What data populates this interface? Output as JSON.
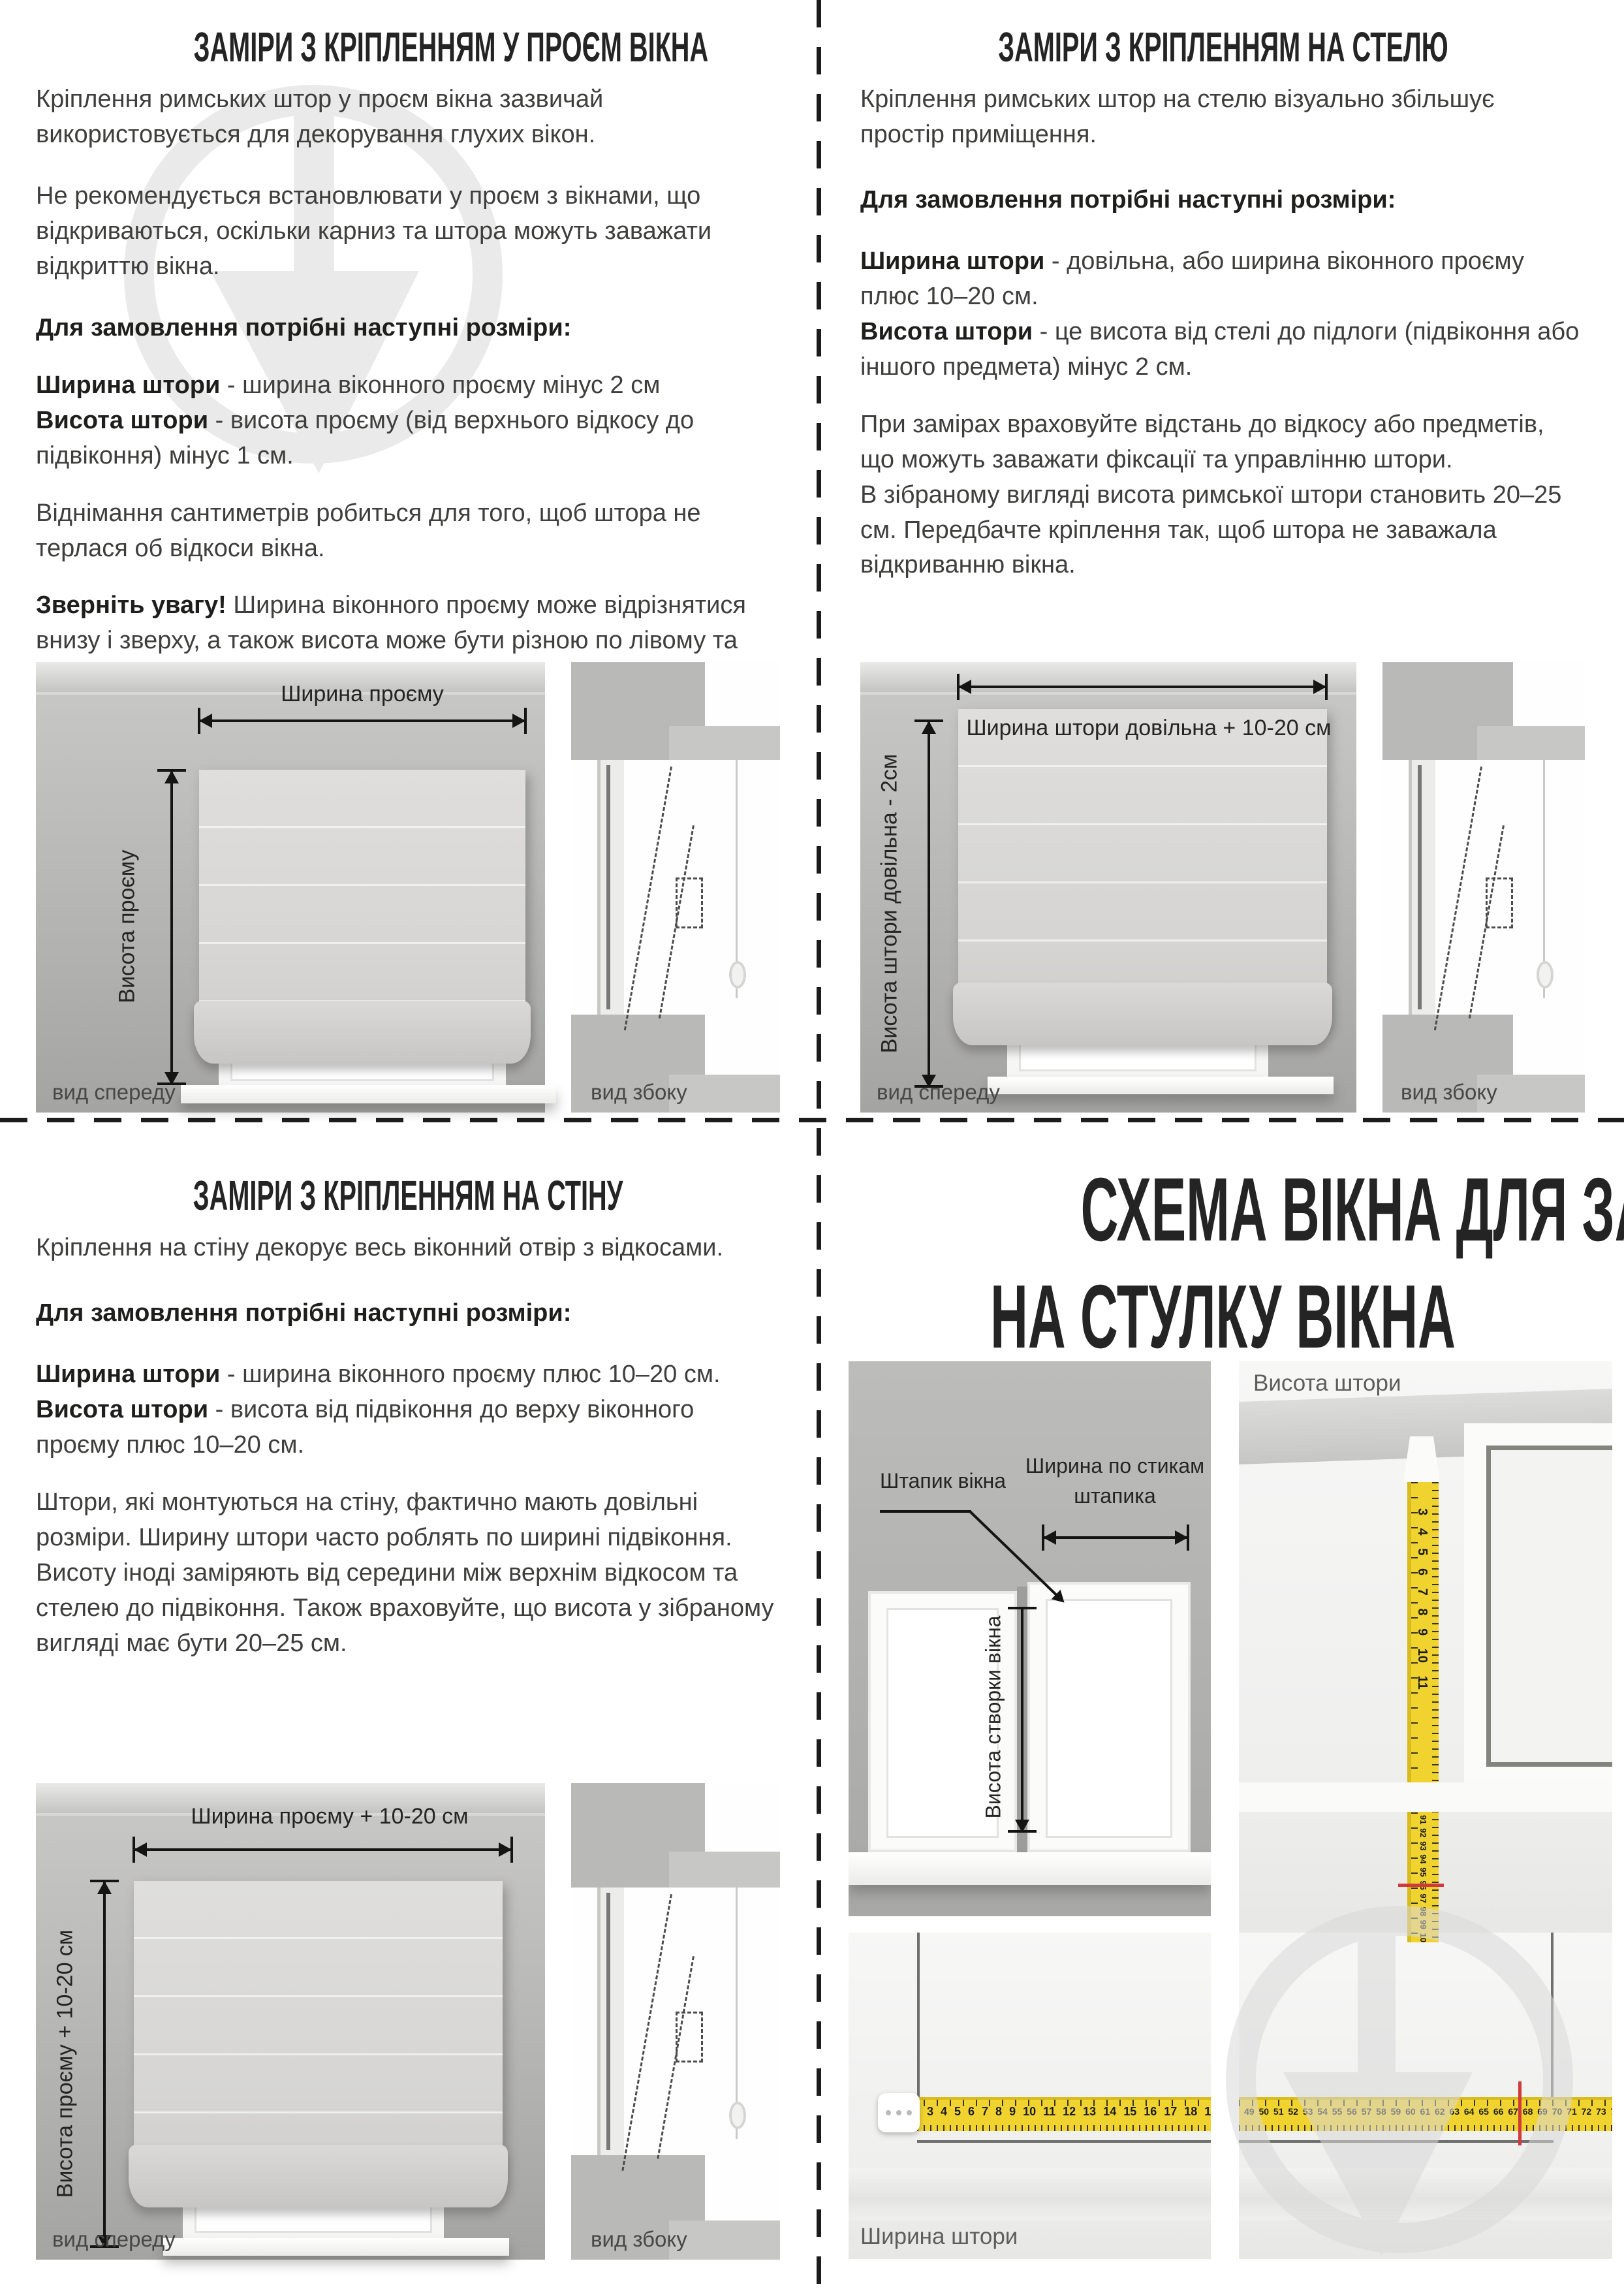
{
  "colors": {
    "tape_yellow": "#f1d32f",
    "red_mark": "#d23a3a",
    "watermark_gray": "#d9d9d9",
    "body_text": "#3e3e3c"
  },
  "opening": {
    "title": "ЗАМІРИ З КРІПЛЕННЯМ У ПРОЄМ ВІКНА",
    "p1": "Кріплення римських штор у проєм вікна зазвичай використовується для декорування глухих вікон.",
    "p2": "Не рекомендується встановлювати у проєм з вікнами, що відкриваються, оскільки карниз та штора можуть заважати відкриттю вікна.",
    "order_intro": "Для замовлення потрібні наступні розміри:",
    "width_term": "Ширина штори",
    "width_rest": " - ширина віконного проєму мінус 2 см",
    "height_term": "Висота штори",
    "height_rest": " - висота проєму (від верхнього відкосу до підвіконня) мінус 1 см.",
    "p3": "Віднімання сантиметрів робиться для того, щоб штора не терлася об відкоси вікна.",
    "note_term": "Зверніть увагу!",
    "note_rest": " Ширина віконного проєму може відрізнятися внизу і зверху, а також висота може бути різною по лівому та правому краях проєму.",
    "diagram": {
      "width_label": "Ширина проєму",
      "height_label": "Висота проєму",
      "front_caption": "вид спереду",
      "side_caption": "вид збоку"
    }
  },
  "ceiling": {
    "title": "ЗАМІРИ З КРІПЛЕННЯМ НА СТЕЛЮ",
    "p1": "Кріплення римських штор на стелю візуально збільшує простір приміщення.",
    "order_intro": "Для замовлення потрібні наступні розміри:",
    "width_term": "Ширина штори",
    "width_rest": " - довільна, або ширина віконного проєму плюс 10–20 см.",
    "height_term": "Висота штори",
    "height_rest": " - це висота від стелі до підлоги (підвіконня або іншого предмета) мінус 2 см.",
    "p2": "При замірах враховуйте відстань до відкосу або предметів, що можуть заважати фіксації та управлінню штори.",
    "p3": "В зібраному вигляді висота римської штори становить 20–25 см. Передбачте кріплення так, щоб штора не заважала відкриванню вікна.",
    "diagram": {
      "width_label": "Ширина штори довільна + 10-20 см",
      "height_label": "Висота штори довільна - 2см",
      "front_caption": "вид спереду",
      "side_caption": "вид збоку"
    }
  },
  "wall": {
    "title": "ЗАМІРИ З КРІПЛЕННЯМ НА СТІНУ",
    "p1": "Кріплення на стіну декорує весь віконний отвір з відкосами.",
    "order_intro": "Для замовлення потрібні наступні розміри:",
    "width_term": "Ширина штори",
    "width_rest": " - ширина віконного проєму плюс 10–20 см.",
    "height_term": "Висота штори",
    "height_rest": " - висота від підвіконня до верху віконного проєму плюс 10–20 см.",
    "p2": "Штори, які монтуються на стіну, фактично мають довільні розміри. Ширину штори часто роблять по ширині підвіконня. Висоту іноді заміряють від середини між верхнім відкосом та стелею до підвіконня. Також враховуйте, що висота у зібраному вигляді має бути 20–25 см.",
    "diagram": {
      "width_label": "Ширина проєму + 10-20 см",
      "height_label": "Висота проєму + 10-20 см",
      "front_caption": "вид спереду",
      "side_caption": "вид збоку"
    }
  },
  "sash": {
    "title_line1": "СХЕМА ВІКНА ДЛЯ ЗАМІРІВ",
    "title_line2": "НА СТУЛКУ ВІКНА",
    "bead_label": "Штапик вікна",
    "joints_label_line1": "Ширина по стикам",
    "joints_label_line2": "штапика",
    "sash_height_label": "Висота створки вікна",
    "curtain_height_label": "Висота штори",
    "curtain_width_label": "Ширина штори",
    "tape_v_top": "3 4 5 6 7 8 9 10 11",
    "tape_v_bottom": "91 92 93 94 95 96 97 98 99 100 101 102 103 104 105 106 107 108 109 110",
    "tape_h_left": "3 4 5 6 7 8 9 10 11 12 13 14 15 16 17 18 19 20 21 22 23 24",
    "tape_h_right": "49 50 51 52 53 54 55 56 57 58 59 60 61 62 63 64 65 66 67 68 69 70 71 72 73 74 75 76 77 78 79 80"
  }
}
